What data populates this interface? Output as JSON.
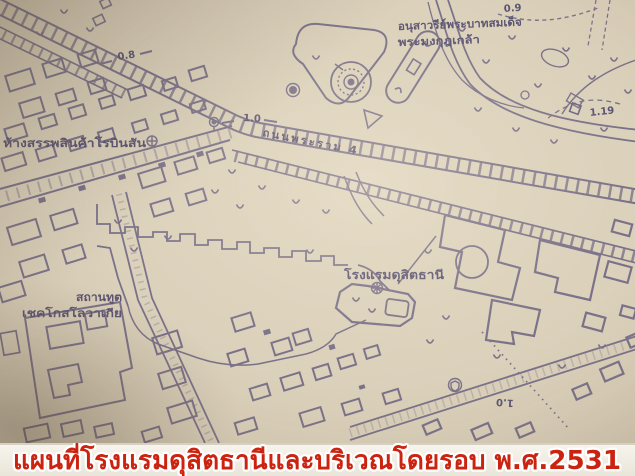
{
  "caption": {
    "text": "แผนที่โรงแรมดุสิตธานีและบริเวณโดยรอบ พ.ศ.2531",
    "text_color": "#cb2310",
    "outline_color": "#ffffff"
  },
  "map": {
    "paper_color": "#d9cfba",
    "ink_color": "#5a5379",
    "text_ink_color": "#453f66",
    "labels": {
      "department_store": "ห้างสรรพสินค้าโรบินสัน",
      "monument_line1": "อนุสาวรีย์พระบาทสมเด็จ",
      "monument_line2": "พระมงกุฎเกล้า",
      "road_rama4": "ถนนพระราม 4",
      "hotel": "โรงแรมดุสิตธานี",
      "embassy_line1": "สถานทูต",
      "embassy_line2": "เชคโกสโลวาเกีย"
    },
    "distance_markers": {
      "m08": "0.8",
      "m10a": "1.0",
      "m09": "0.9",
      "m119": "1.19",
      "m10b": "1.0"
    },
    "symbols": [
      "circled-cross-icon (department store)",
      "circled-asterisk-icon (hotel)",
      "landmark-icon (roadside)",
      "shield-icon (bottom right)",
      "monument-circle (traffic island)",
      "tree-marks"
    ]
  }
}
